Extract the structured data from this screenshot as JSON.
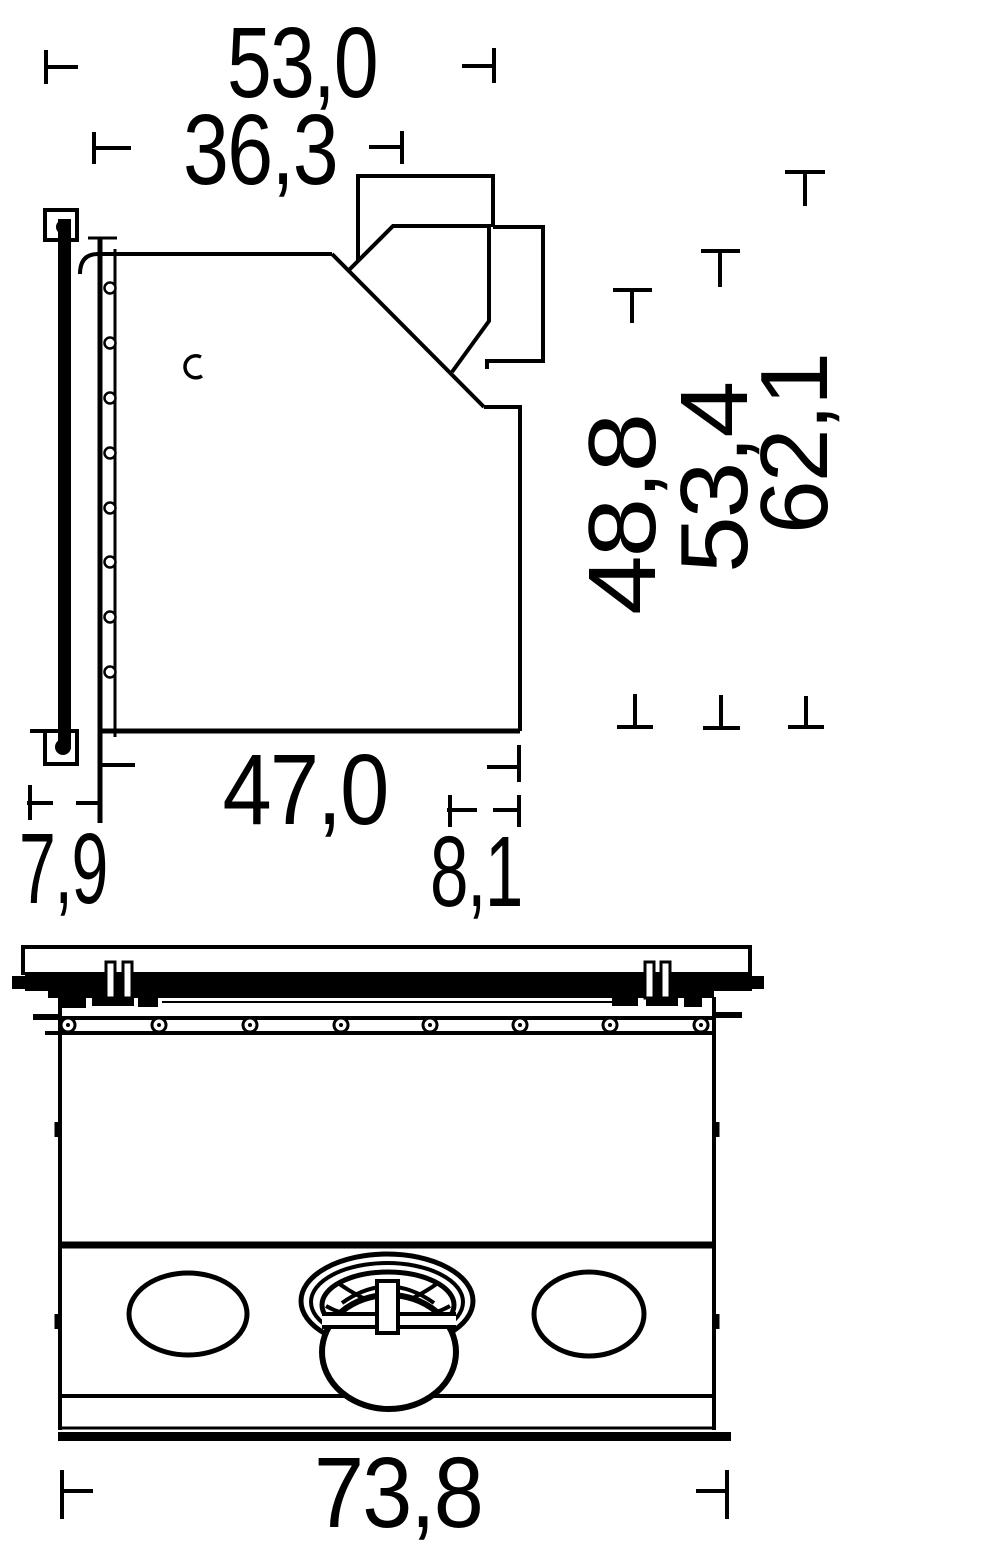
{
  "document": {
    "kind": "technical dimension drawing",
    "background_color": "#ffffff",
    "line_color": "#000000"
  },
  "side_view": {
    "dimensions": {
      "width_top": "53,0",
      "width_inner": "36,3",
      "height_a": "48,8",
      "height_b": "53,4",
      "height_c": "62,1",
      "depth_bottom": "47,0",
      "front": "7,9",
      "rear": "8,1"
    }
  },
  "top_view": {
    "dimensions": {
      "overall_width": "73,8"
    }
  }
}
